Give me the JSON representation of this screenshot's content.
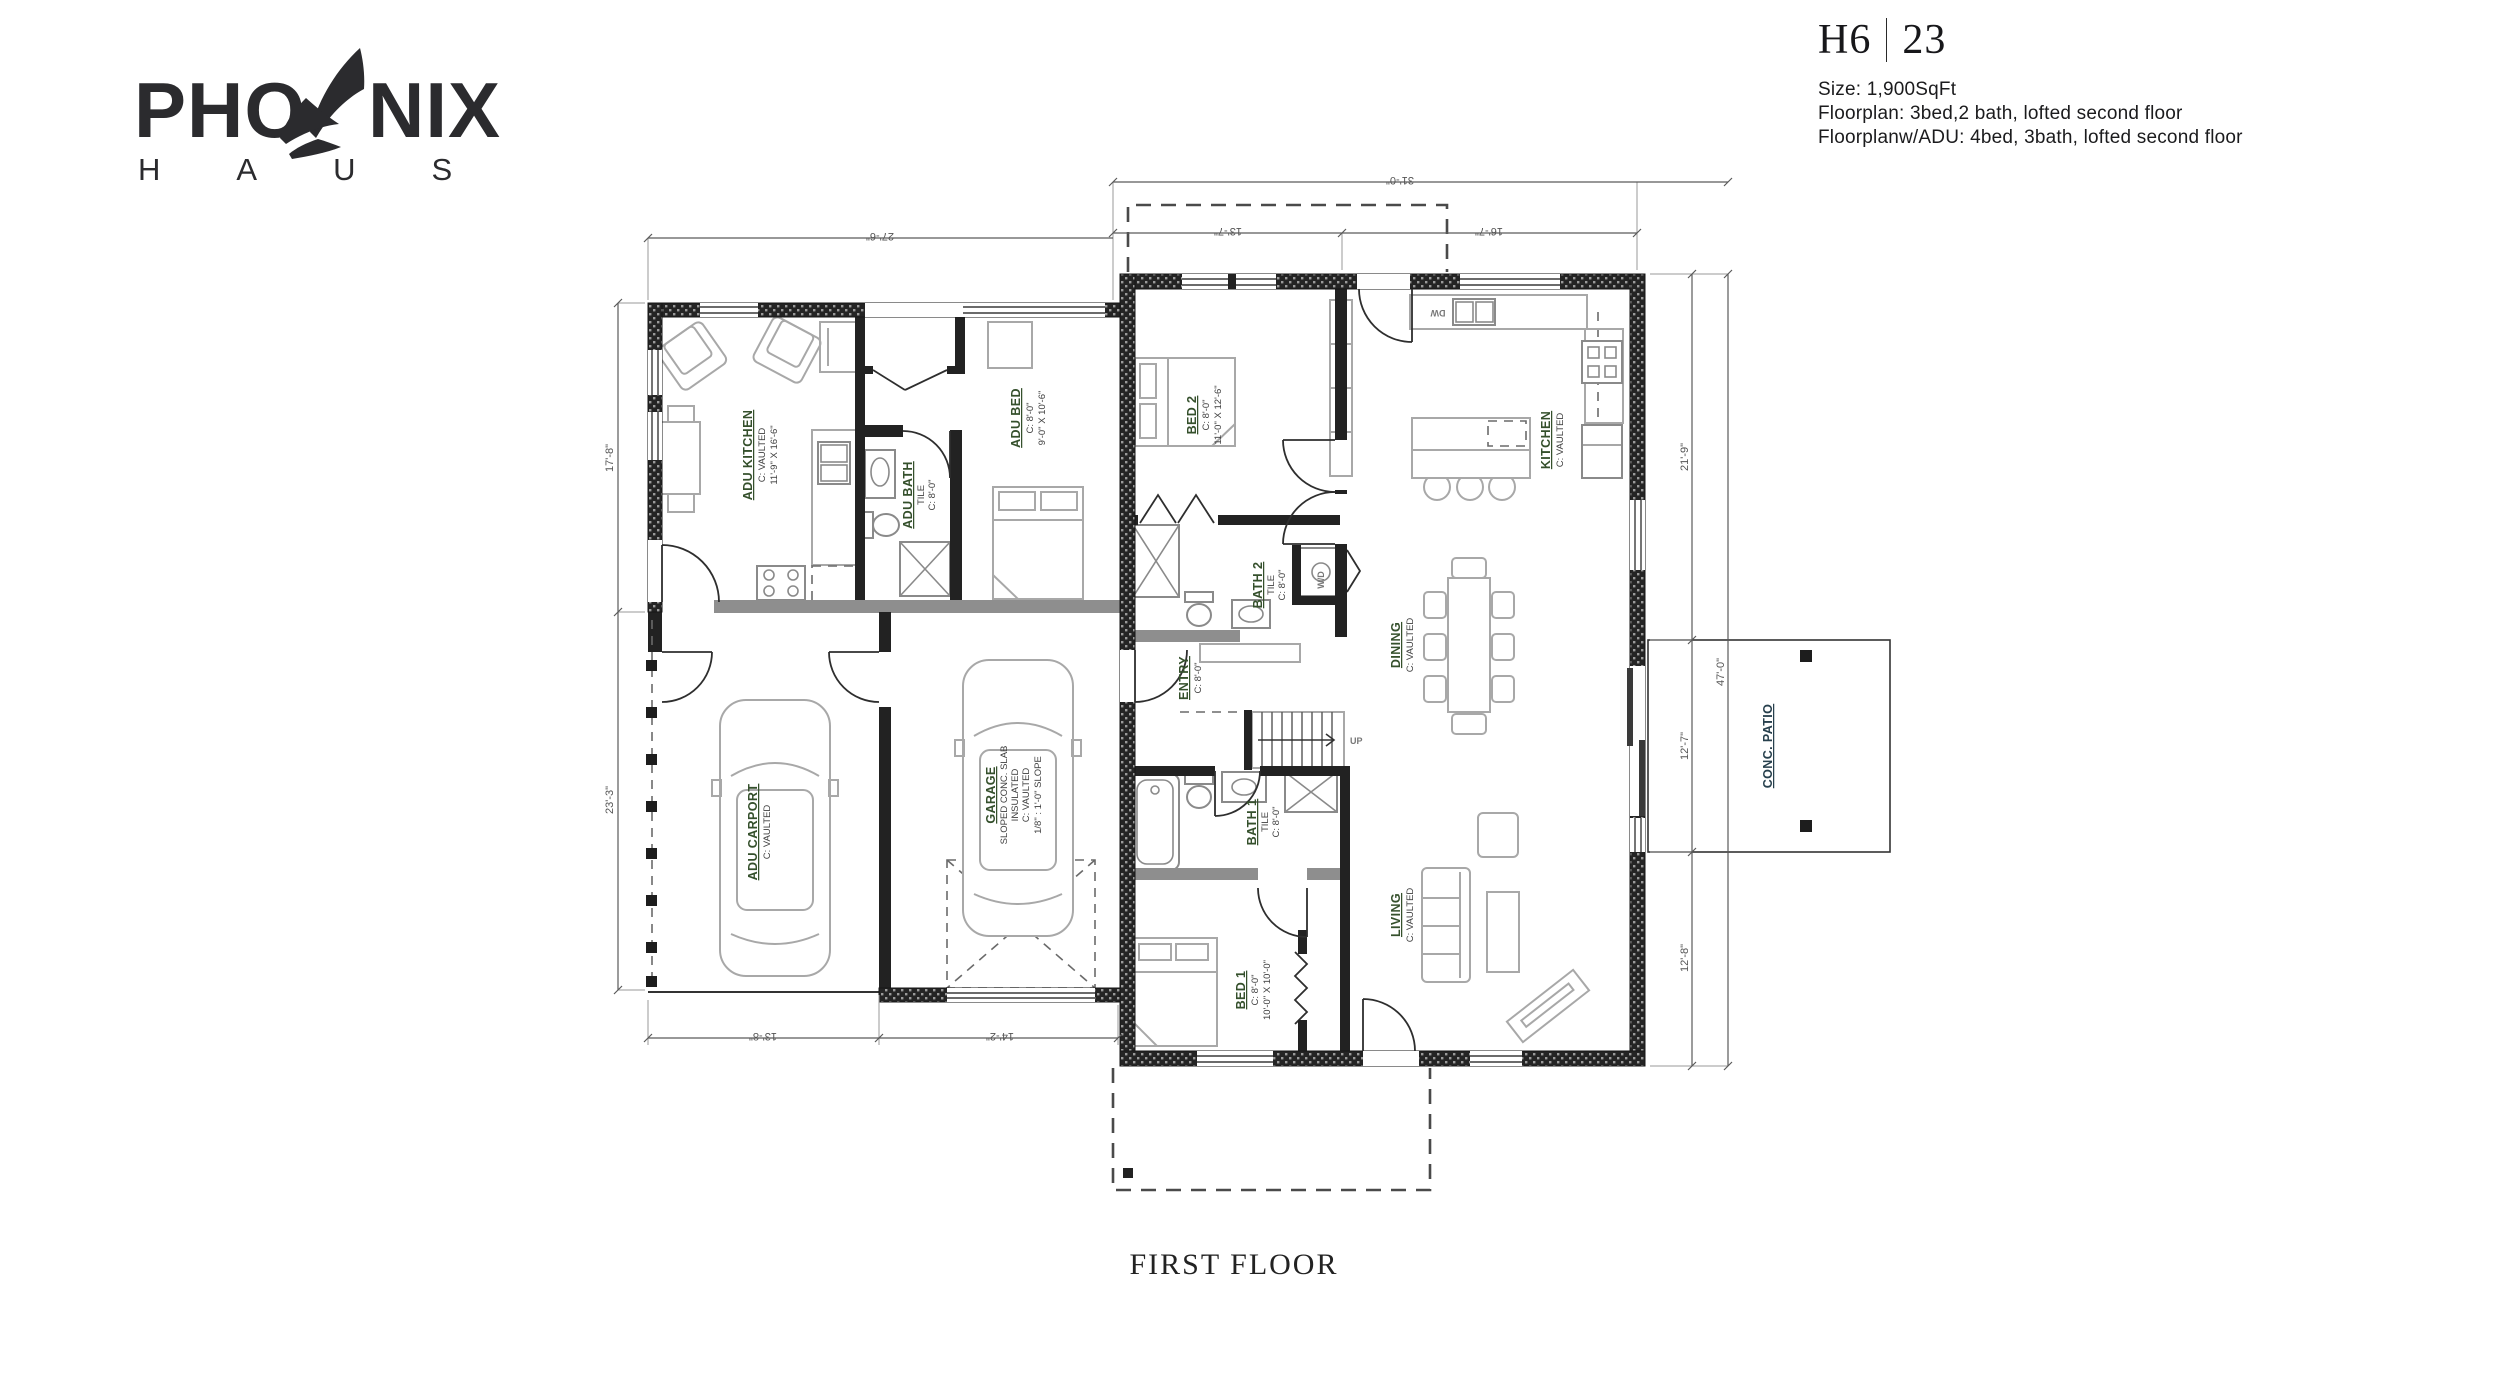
{
  "brand": {
    "logo_word_left": "PHO",
    "logo_word_right": "NIX",
    "logo_sub": "HAUS",
    "wing_icon": "feather-wing-icon"
  },
  "header": {
    "model": "H6",
    "variant": "23",
    "size": "Size: 1,900SqFt",
    "floorplan": "Floorplan: 3bed,2 bath, lofted second floor",
    "floorplan_adu": "Floorplanw/ADU: 4bed, 3bath, lofted second floor"
  },
  "floor_label": "FIRST FLOOR",
  "rooms": {
    "adu_kitchen": {
      "name": "ADU KITCHEN",
      "ceiling": "C: VAULTED",
      "dims": "11'-9\" X 16'-6\""
    },
    "adu_bath": {
      "name": "ADU BATH",
      "finish": "TILE",
      "ceiling": "C: 8'-0\""
    },
    "adu_bed": {
      "name": "ADU BED",
      "ceiling": "C: 8'-0\"",
      "dims": "9'-0\" X 10'-6\""
    },
    "adu_carport": {
      "name": "ADU CARPORT",
      "ceiling": "C: VAULTED"
    },
    "garage": {
      "name": "GARAGE",
      "note1": "SLOPED CONC. SLAB",
      "note2": "INSULATED",
      "ceiling": "C: VAULTED",
      "slope": "1/8\" : 1'-0\" SLOPE"
    },
    "bed2": {
      "name": "BED 2",
      "ceiling": "C: 8'-0\"",
      "dims": "11'-0\" X 12'-6\""
    },
    "bath2": {
      "name": "BATH 2",
      "finish": "TILE",
      "ceiling": "C: 8'-0\""
    },
    "entry": {
      "name": "ENTRY",
      "ceiling": "C: 8'-0\""
    },
    "kitchen": {
      "name": "KITCHEN",
      "ceiling": "C: VAULTED"
    },
    "dining": {
      "name": "DINING",
      "ceiling": "C: VAULTED"
    },
    "living": {
      "name": "LIVING",
      "ceiling": "C: VAULTED"
    },
    "bath1": {
      "name": "BATH 1",
      "finish": "TILE",
      "ceiling": "C: 8'-0\""
    },
    "bed1": {
      "name": "BED 1",
      "ceiling": "C: 8'-0\"",
      "dims": "10'-0\" X 10'-0\""
    },
    "conc_patio": {
      "name": "CONC. PATIO"
    }
  },
  "annotations": {
    "stairs_up": "UP",
    "dishwasher": "DW",
    "washer_dryer": "W/D"
  },
  "dimensions": {
    "top_main_total": "31'-0\"",
    "top_adu": "27'-6\"",
    "top_bed2": "13'-7\"",
    "top_kitchen": "16'-7\"",
    "left_adu": "17'-8\"",
    "left_carport": "23'-3\"",
    "right_upper": "21'-9\"",
    "right_patio": "12'-7\"",
    "right_lower": "12'-8\"",
    "right_total": "47'-0\"",
    "bottom_carport": "13'-8\"",
    "bottom_garage": "14'-2\""
  },
  "colors": {
    "room_label": "#35502c",
    "wall": "#1c1c1c",
    "dim_text": "#555555",
    "furniture": "#a8a8a8"
  }
}
